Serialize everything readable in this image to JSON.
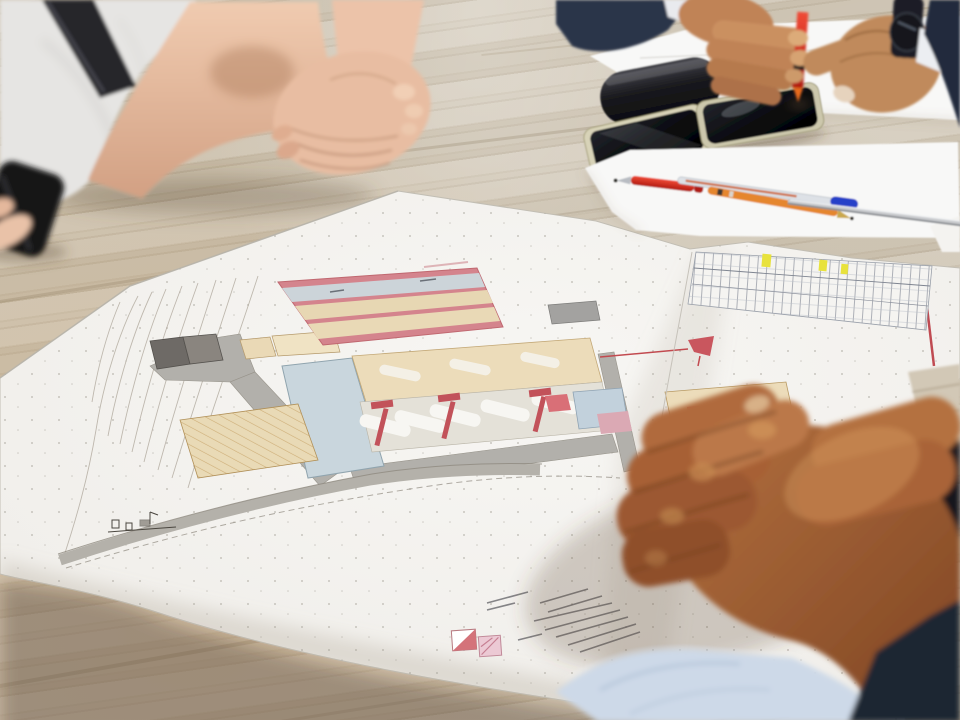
{
  "scene": {
    "setting": "meeting-table-with-architectural-site-plan",
    "people": [
      {
        "id": "person-top-left",
        "visible_parts": "torso-and-clasped-hands",
        "clothing": "light-gray-tshirt",
        "accessory": "black-shoulder-strap"
      },
      {
        "id": "person-top-right",
        "visible_parts": "both-hands-fiddling-with-red-pen",
        "clothing": "dark-navy-suit-with-white-shirt",
        "accessory": "black-wristwatch"
      },
      {
        "id": "person-bottom-right",
        "visible_parts": "large-clasped-hands",
        "clothing": "navy-suit-with-light-blue-shirt-cuff"
      }
    ],
    "objects": [
      {
        "id": "site-plan-sheet",
        "kind": "large-architectural-site-plan-drawing"
      },
      {
        "id": "glasses-case",
        "kind": "black-cylindrical-case"
      },
      {
        "id": "smartphone-1",
        "kind": "smartphone-black-screen-gold-frame"
      },
      {
        "id": "smartphone-2",
        "kind": "smartphone-black-screen-gold-frame"
      },
      {
        "id": "paper-sheet-top",
        "kind": "white-paper-sheet"
      },
      {
        "id": "paper-sheet-pens",
        "kind": "white-paper-sheet"
      },
      {
        "id": "paper-corner-right",
        "kind": "white-paper-corner"
      },
      {
        "id": "pen-red-horizontal",
        "kind": "red-ballpoint-pen"
      },
      {
        "id": "pen-blue-cap",
        "kind": "silver-pen-with-blue-cap"
      },
      {
        "id": "pen-orange",
        "kind": "orange-multicolor-pen"
      },
      {
        "id": "pen-silver-long",
        "kind": "long-metallic-pen"
      },
      {
        "id": "pen-red-vertical",
        "kind": "red-pen-held-upright"
      },
      {
        "id": "black-object-left",
        "kind": "dark-object-held-at-left-edge"
      }
    ],
    "site_plan_features": [
      "pink-bordered-block-with-three-bands",
      "schedule-table-with-yellow-highlight-cells",
      "topographic-contour-lines",
      "gray-roads",
      "dark-gray-buildings",
      "hatched-parking-area",
      "beige-building-strips-with-red-tower-symbols",
      "light-blue-area",
      "red-boundary-lines",
      "legend-with-two-color-swatches",
      "scattered-survey-dots"
    ]
  },
  "palette": {
    "wood_base": "#c9bfad",
    "plan_paper": "#f3f2ef",
    "paper_white": "#f8f8f7",
    "plan_pink": "#d4848d",
    "plan_band_blue": "#ccd4d9",
    "plan_band_beige": "#e7d7b3",
    "plan_beige": "#ecdcba",
    "plan_light_blue": "#c9d6dd",
    "plan_red": "#c2525a",
    "plan_road_gray": "#b2b0ab",
    "plan_dark_building": "#6e6a66",
    "highlight_yellow": "#e8e23c",
    "skin_fair": "#e8bda2",
    "skin_medium": "#c08357",
    "skin_tan": "#a35d31",
    "suit_navy": "#2b3448",
    "suit_dark": "#1c2533",
    "cuff_blue": "#cdd9e8",
    "shirt_gray": "#e6e5e3",
    "shirt_white": "#e9eaee",
    "case_black": "#141418",
    "pen_red": "#d0241c",
    "pen_blue": "#2741c8",
    "pen_orange": "#e5862f",
    "metal_silver": "#c3c5c8",
    "watch_black": "#1c1f26"
  }
}
